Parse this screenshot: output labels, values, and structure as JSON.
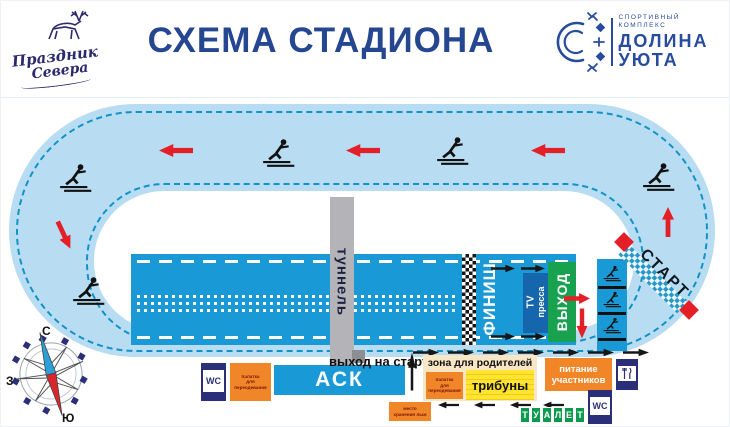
{
  "header": {
    "title": "СХЕМА СТАДИОНА",
    "logo_left": {
      "line1": "Праздник",
      "line2": "Севера"
    },
    "logo_right": {
      "tagline1": "спортивный",
      "tagline2": "комплекс",
      "name1": "ДОЛИНА",
      "name2": "УЮТА"
    }
  },
  "track": {
    "start": "СТАРТ",
    "finish": "ФИНИШ",
    "tunnel": "туннель",
    "tv_line1": "TV",
    "tv_line2": "пресса",
    "exit": "ВЫХОД"
  },
  "facilities": {
    "exit_to_start": "выход на старт",
    "ask": "АСК",
    "wc": "WC",
    "changing_tent_l1": "палатка",
    "changing_tent_l2": "для",
    "changing_tent_l3": "переодевания",
    "parents_zone": "зона для родителей",
    "stands": "трибуны",
    "food_l1": "питание",
    "food_l2": "участников",
    "ski_storage_l1": "место",
    "ski_storage_l2": "хранения лыж",
    "toilet_letters": [
      "Т",
      "У",
      "А",
      "Л",
      "Е",
      "Т"
    ]
  },
  "compass": {
    "north": "С",
    "south": "Ю",
    "west": "З"
  },
  "colors": {
    "stadium_blue": "#199ad6",
    "track_fill": "#b8ddf3",
    "dash_teal": "#1292c6",
    "red": "#e32028",
    "orange": "#f08627",
    "yellow": "#ffe431",
    "green_exit": "#18a24f",
    "navy": "#2b2f7a",
    "cream": "#f9e6c4",
    "toilet_green": "#0d9a4e",
    "title_navy": "#254691"
  }
}
